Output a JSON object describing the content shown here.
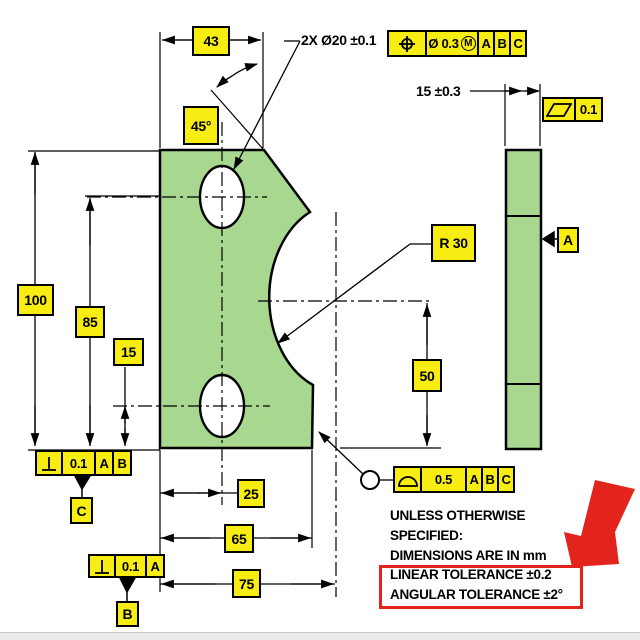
{
  "drawing": {
    "callouts": {
      "holes": "2X Ø20 ±0.1",
      "thickness": "15 ±0.3",
      "radius": "R 30"
    },
    "dims": {
      "d43": "43",
      "d45": "45°",
      "d100": "100",
      "d85": "85",
      "d15": "15",
      "d25": "25",
      "d65": "65",
      "d75": "75",
      "d50": "50"
    },
    "fcf": {
      "position": {
        "symbol": "position-icon",
        "tolerance": "Ø 0.3",
        "modifier": "M",
        "datum1": "A",
        "datum2": "B",
        "datum3": "C"
      },
      "parallelism": {
        "symbol": "parallelism-icon",
        "tolerance": "0.1"
      },
      "perp_left": {
        "symbol": "perpendicularity-icon",
        "tolerance": "0.1",
        "datum1": "A",
        "datum2": "B"
      },
      "perp_bottom": {
        "symbol": "perpendicularity-icon",
        "tolerance": "0.1",
        "datum1": "A"
      },
      "profile": {
        "symbol": "profile-of-a-surface-icon",
        "tolerance": "0.5",
        "datum1": "A",
        "datum2": "B",
        "datum3": "C"
      }
    },
    "datum_labels": {
      "a": "A",
      "b": "B",
      "c": "C"
    },
    "notes": [
      "UNLESS OTHERWISE",
      "SPECIFIED:",
      "DIMENSIONS ARE IN mm",
      "LINEAR TOLERANCE ±0.2",
      "ANGULAR TOLERANCE ±2°"
    ],
    "colors": {
      "part_fill": "#a8d88f",
      "label_fill": "#f7ed13",
      "highlight_red": "#e3241d"
    }
  }
}
